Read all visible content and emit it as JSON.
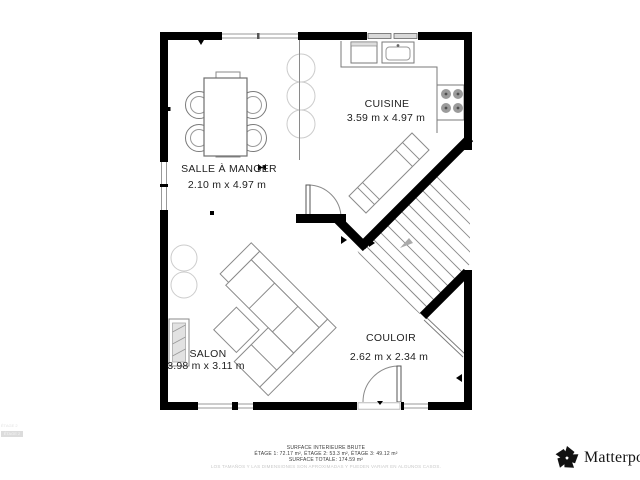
{
  "rooms": [
    {
      "id": "cuisine",
      "name": "CUISINE",
      "dims": "3.59 m x 4.97 m"
    },
    {
      "id": "salle-a-manger",
      "name": "SALLE À MANGER",
      "dims": "2.10 m x 4.97 m"
    },
    {
      "id": "salon",
      "name": "SALON",
      "dims": "3.98 m x 3.11 m"
    },
    {
      "id": "couloir",
      "name": "COULOIR",
      "dims": "2.62 m x 2.34 m"
    }
  ],
  "footer": {
    "title": "SURFACE INTERIEURE BRUTE",
    "floors": "ÉTAGE 1: 72.17 m², ÉTAGE 2: 53.3 m², ÉTAGE 3: 49.12 m²",
    "total": "SURFACE TOTALE: 174.59 m²",
    "disclaimer": "LOS TAMAÑOS Y LAS DIMENSIONES SON APROXIMADAS Y PUEDEN VARIAR EN ALGUNOS CASOS."
  },
  "watermark": "ÉTAGE 2",
  "brand": {
    "name": "Matterport"
  },
  "colors": {
    "wall": "#000000",
    "thin_line": "#777777",
    "light_line": "#cccccc",
    "text": "#222222",
    "disclaimer_text": "#c9c9c9"
  }
}
